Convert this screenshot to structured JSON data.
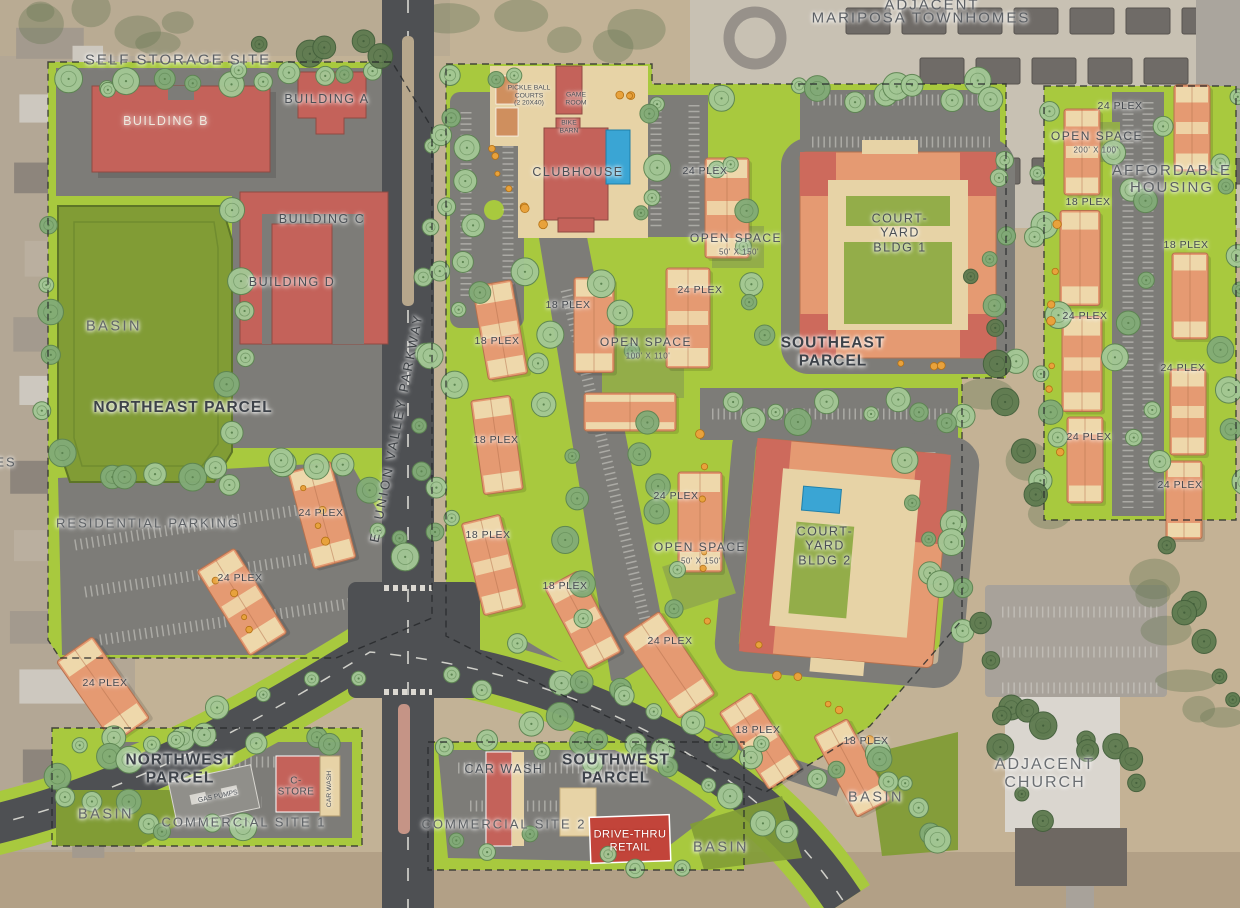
{
  "palette": {
    "grass": "#a8c93e",
    "basin": "#819c35",
    "lot": "#7d7c78",
    "road": "#4e5053",
    "red": "#c4625a",
    "apt": "#e59a72",
    "tan": "#eed8ab",
    "tan2": "#e7d3a6",
    "court": "#93ad49",
    "pool": "#3aa5d4",
    "dirt": "#c2b296",
    "label": "#4a4f55"
  },
  "map": {
    "labels": [
      {
        "text": "ADJACENT",
        "x": 932,
        "y": 5,
        "kind": "area-title"
      },
      {
        "text": "MARIPOSA TOWNHOMES",
        "x": 921,
        "y": 18,
        "kind": "area-title"
      },
      {
        "text": "SELF STORAGE SITE",
        "x": 178,
        "y": 60,
        "kind": "area-title"
      },
      {
        "text": "BUILDING B",
        "x": 166,
        "y": 121,
        "kind": "building-light"
      },
      {
        "text": "BUILDING A",
        "x": 327,
        "y": 99,
        "kind": "building"
      },
      {
        "text": "BUILDING C",
        "x": 322,
        "y": 219,
        "kind": "building"
      },
      {
        "text": "BUILDING D",
        "x": 292,
        "y": 282,
        "kind": "building"
      },
      {
        "text": "BASIN",
        "x": 114,
        "y": 327,
        "kind": "basin"
      },
      {
        "text": "NORTHEAST PARCEL",
        "x": 183,
        "y": 408,
        "kind": "parcel"
      },
      {
        "text": "RESIDENTIAL PARKING",
        "x": 148,
        "y": 524,
        "kind": "area-sub"
      },
      {
        "text": "24 PLEX",
        "x": 321,
        "y": 514,
        "kind": "plex"
      },
      {
        "text": "24 PLEX",
        "x": 240,
        "y": 579,
        "kind": "plex"
      },
      {
        "text": "24 PLEX",
        "x": 105,
        "y": 684,
        "kind": "plex"
      },
      {
        "text": "ES",
        "x": 6,
        "y": 463,
        "kind": "area-sub"
      },
      {
        "text": "PICKLE BALL\nCOURTS\n(2 20X40)",
        "x": 529,
        "y": 96,
        "kind": "tiny"
      },
      {
        "text": "GAME\nROOM",
        "x": 576,
        "y": 99,
        "kind": "tiny"
      },
      {
        "text": "BIKE\nBARN",
        "x": 569,
        "y": 127,
        "kind": "tiny"
      },
      {
        "text": "CLUBHOUSE",
        "x": 578,
        "y": 172,
        "kind": "building"
      },
      {
        "text": "24 PLEX",
        "x": 705,
        "y": 172,
        "kind": "plex"
      },
      {
        "text": "OPEN SPACE",
        "x": 736,
        "y": 239,
        "kind": "open-space"
      },
      {
        "text": "50' X 150'",
        "x": 739,
        "y": 252,
        "kind": "dim"
      },
      {
        "text": "18 PLEX",
        "x": 568,
        "y": 306,
        "kind": "plex"
      },
      {
        "text": "24 PLEX",
        "x": 700,
        "y": 291,
        "kind": "plex"
      },
      {
        "text": "OPEN SPACE",
        "x": 646,
        "y": 343,
        "kind": "open-space"
      },
      {
        "text": "100' X 110'",
        "x": 648,
        "y": 356,
        "kind": "dim"
      },
      {
        "text": "18 PLEX",
        "x": 497,
        "y": 342,
        "kind": "plex"
      },
      {
        "text": "18 PLEX",
        "x": 496,
        "y": 441,
        "kind": "plex"
      },
      {
        "text": "24 PLEX",
        "x": 676,
        "y": 497,
        "kind": "plex"
      },
      {
        "text": "18 PLEX",
        "x": 488,
        "y": 536,
        "kind": "plex"
      },
      {
        "text": "OPEN SPACE",
        "x": 700,
        "y": 548,
        "kind": "open-space"
      },
      {
        "text": "50' X 150'",
        "x": 701,
        "y": 561,
        "kind": "dim"
      },
      {
        "text": "18 PLEX",
        "x": 565,
        "y": 587,
        "kind": "plex"
      },
      {
        "text": "SOUTHEAST\nPARCEL",
        "x": 833,
        "y": 352,
        "kind": "parcel"
      },
      {
        "text": "COURT-\nYARD\nBLDG 1",
        "x": 900,
        "y": 233,
        "kind": "building"
      },
      {
        "text": "COURT-\nYARD\nBLDG 2",
        "x": 825,
        "y": 546,
        "kind": "building"
      },
      {
        "text": "24 PLEX",
        "x": 670,
        "y": 642,
        "kind": "plex"
      },
      {
        "text": "18 PLEX",
        "x": 758,
        "y": 731,
        "kind": "plex"
      },
      {
        "text": "18 PLEX",
        "x": 866,
        "y": 742,
        "kind": "plex"
      },
      {
        "text": "BASIN",
        "x": 876,
        "y": 798,
        "kind": "basin"
      },
      {
        "text": "24 PLEX",
        "x": 1120,
        "y": 107,
        "kind": "plex"
      },
      {
        "text": "OPEN SPACE",
        "x": 1097,
        "y": 137,
        "kind": "open-space"
      },
      {
        "text": "200' X 100'",
        "x": 1096,
        "y": 150,
        "kind": "dim"
      },
      {
        "text": "AFFORDABLE\nHOUSING",
        "x": 1172,
        "y": 179,
        "kind": "area-title"
      },
      {
        "text": "18 PLEX",
        "x": 1088,
        "y": 203,
        "kind": "plex"
      },
      {
        "text": "18 PLEX",
        "x": 1186,
        "y": 246,
        "kind": "plex"
      },
      {
        "text": "24 PLEX",
        "x": 1085,
        "y": 317,
        "kind": "plex"
      },
      {
        "text": "24 PLEX",
        "x": 1183,
        "y": 369,
        "kind": "plex"
      },
      {
        "text": "24 PLEX",
        "x": 1089,
        "y": 438,
        "kind": "plex"
      },
      {
        "text": "24 PLEX",
        "x": 1180,
        "y": 486,
        "kind": "plex"
      },
      {
        "text": "E. UNION VALLEY PARKWAY",
        "x": 397,
        "y": 428,
        "kind": "road",
        "rot": -79
      },
      {
        "text": "NORTHWEST\nPARCEL",
        "x": 180,
        "y": 769,
        "kind": "parcel"
      },
      {
        "text": "GAS PUMPS",
        "x": 218,
        "y": 797,
        "kind": "tiny",
        "rot": -12
      },
      {
        "text": "C-\nSTORE",
        "x": 296,
        "y": 787,
        "kind": "building-sm"
      },
      {
        "text": "CAR WASH",
        "x": 330,
        "y": 789,
        "kind": "tiny",
        "rot": -90
      },
      {
        "text": "BASIN",
        "x": 106,
        "y": 815,
        "kind": "basin"
      },
      {
        "text": "COMMERCIAL SITE 1",
        "x": 244,
        "y": 823,
        "kind": "area-sub"
      },
      {
        "text": "CAR WASH",
        "x": 504,
        "y": 769,
        "kind": "building"
      },
      {
        "text": "SOUTHWEST\nPARCEL",
        "x": 616,
        "y": 769,
        "kind": "parcel"
      },
      {
        "text": "COMMERCIAL SITE 2",
        "x": 504,
        "y": 825,
        "kind": "area-sub"
      },
      {
        "text": "DRIVE-THRU\nRETAIL",
        "x": 630,
        "y": 841,
        "kind": "drive-thru"
      },
      {
        "text": "BASIN",
        "x": 721,
        "y": 848,
        "kind": "basin"
      },
      {
        "text": "ADJACENT\nCHURCH",
        "x": 1045,
        "y": 774,
        "kind": "church"
      }
    ]
  }
}
